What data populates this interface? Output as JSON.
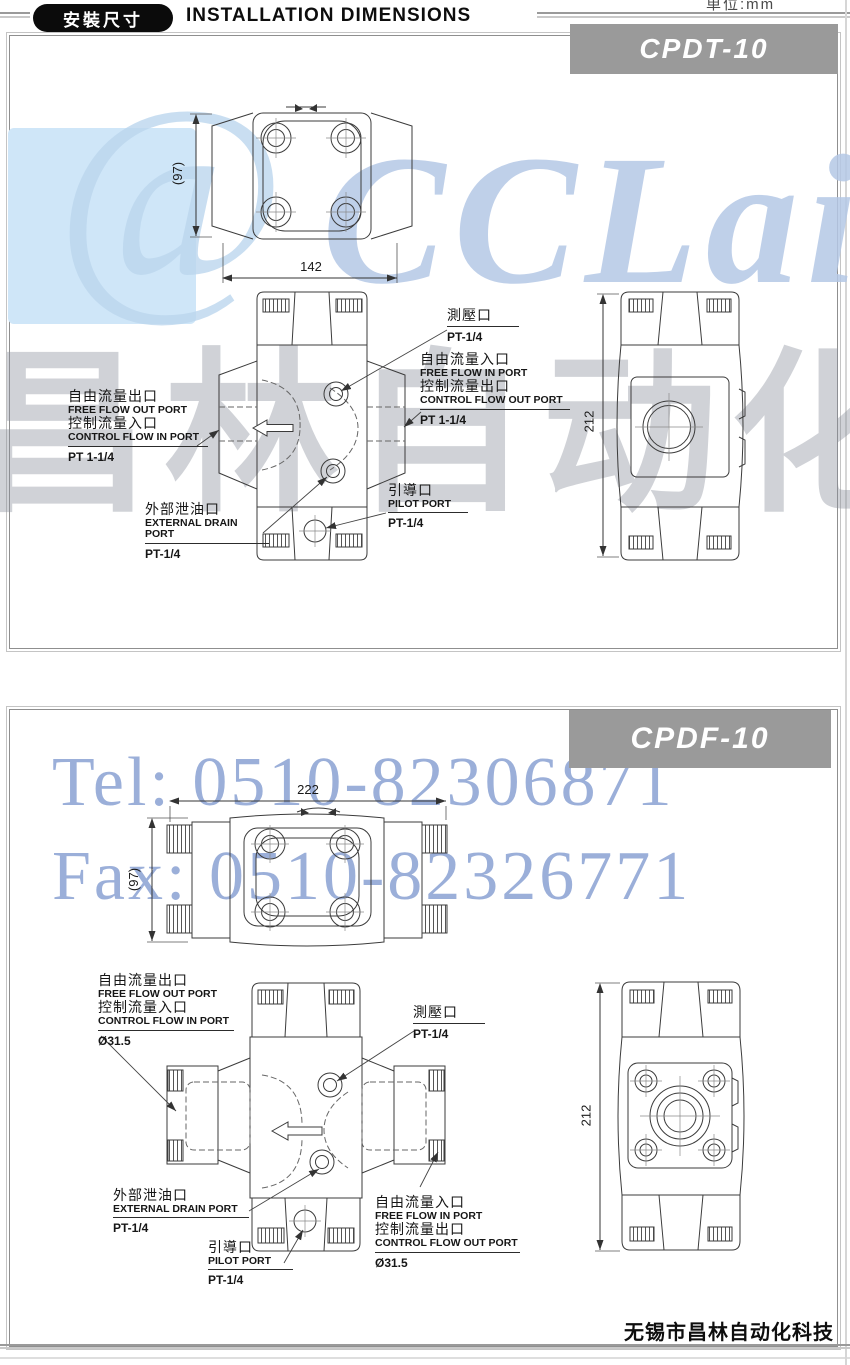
{
  "header": {
    "badge": "安裝尺寸",
    "title": "INSTALLATION DIMENSIONS",
    "unit_note": "单位:mm"
  },
  "watermark": {
    "at_glyph": "@",
    "brand": "CCLair",
    "cjk": "昌林自动化",
    "tel": "Tel: 0510-82306871",
    "fax": "Fax: 0510-82326771"
  },
  "footer": {
    "company": "无锡市昌林自动化科技"
  },
  "panel1": {
    "model": "CPDT-10",
    "dim_depth": "(97)",
    "dim_width": "142",
    "dim_height": "212",
    "labels": {
      "free_out": {
        "zh1": "自由流量出口",
        "en1": "FREE FLOW OUT PORT",
        "zh2": "控制流量入口",
        "en2": "CONTROL FLOW IN PORT",
        "size": "PT 1-1/4"
      },
      "gauge": {
        "zh": "測壓口",
        "size": "PT-1/4"
      },
      "free_in": {
        "zh1": "自由流量入口",
        "en1": "FREE FLOW IN PORT",
        "zh2": "控制流量出口",
        "en2": "CONTROL FLOW OUT PORT",
        "size": "PT 1-1/4"
      },
      "drain": {
        "zh": "外部泄油口",
        "en": "EXTERNAL DRAIN PORT",
        "size": "PT-1/4"
      },
      "pilot": {
        "zh": "引導口",
        "en": "PILOT PORT",
        "size": "PT-1/4"
      }
    }
  },
  "panel2": {
    "model": "CPDF-10",
    "dim_depth": "(97)",
    "dim_width": "222",
    "dim_height": "212",
    "labels": {
      "free_out": {
        "zh1": "自由流量出口",
        "en1": "FREE FLOW OUT PORT",
        "zh2": "控制流量入口",
        "en2": "CONTROL FLOW IN PORT",
        "size": "Ø31.5"
      },
      "gauge": {
        "zh": "測壓口",
        "size": "PT-1/4"
      },
      "free_in": {
        "zh1": "自由流量入口",
        "en1": "FREE FLOW IN PORT",
        "zh2": "控制流量出口",
        "en2": "CONTROL FLOW OUT PORT",
        "size": "Ø31.5"
      },
      "drain": {
        "zh": "外部泄油口",
        "en": "EXTERNAL DRAIN PORT",
        "size": "PT-1/4"
      },
      "pilot": {
        "zh": "引導口",
        "en": "PILOT PORT",
        "size": "PT-1/4"
      }
    }
  }
}
